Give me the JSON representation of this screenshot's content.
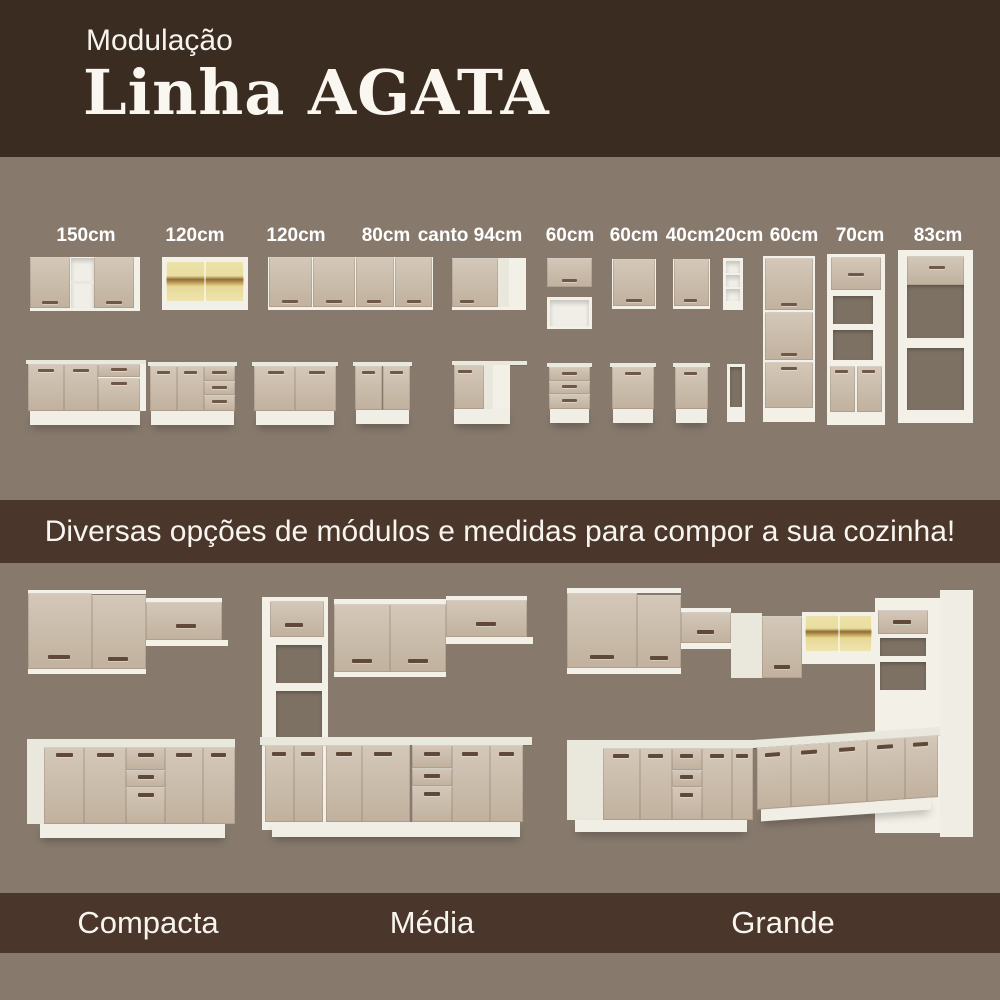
{
  "header": {
    "kicker": "Modulação",
    "title": "Linha AGATA"
  },
  "modules_section": {
    "labels": [
      "150cm",
      "120cm",
      "120cm",
      "80cm",
      "canto 94cm",
      "60cm",
      "60cm",
      "40cm",
      "20cm",
      "60cm",
      "70cm",
      "83cm"
    ]
  },
  "banner": {
    "text": "Diversas opções de módulos e medidas para compor a sua cozinha!"
  },
  "kitchens_section": {
    "labels": [
      "Compacta",
      "Média",
      "Grande"
    ]
  },
  "colors": {
    "background": "#877a6d",
    "header_bg": "#3b2c21",
    "band_bg": "#4a362a",
    "cabinet_beige": "#cbbdac",
    "cabinet_white": "#f3f0e8",
    "counter": "#e9e8dc",
    "handle": "#6f5847",
    "glass_yellow": "#e9dd9e",
    "text": "#ffffff"
  }
}
